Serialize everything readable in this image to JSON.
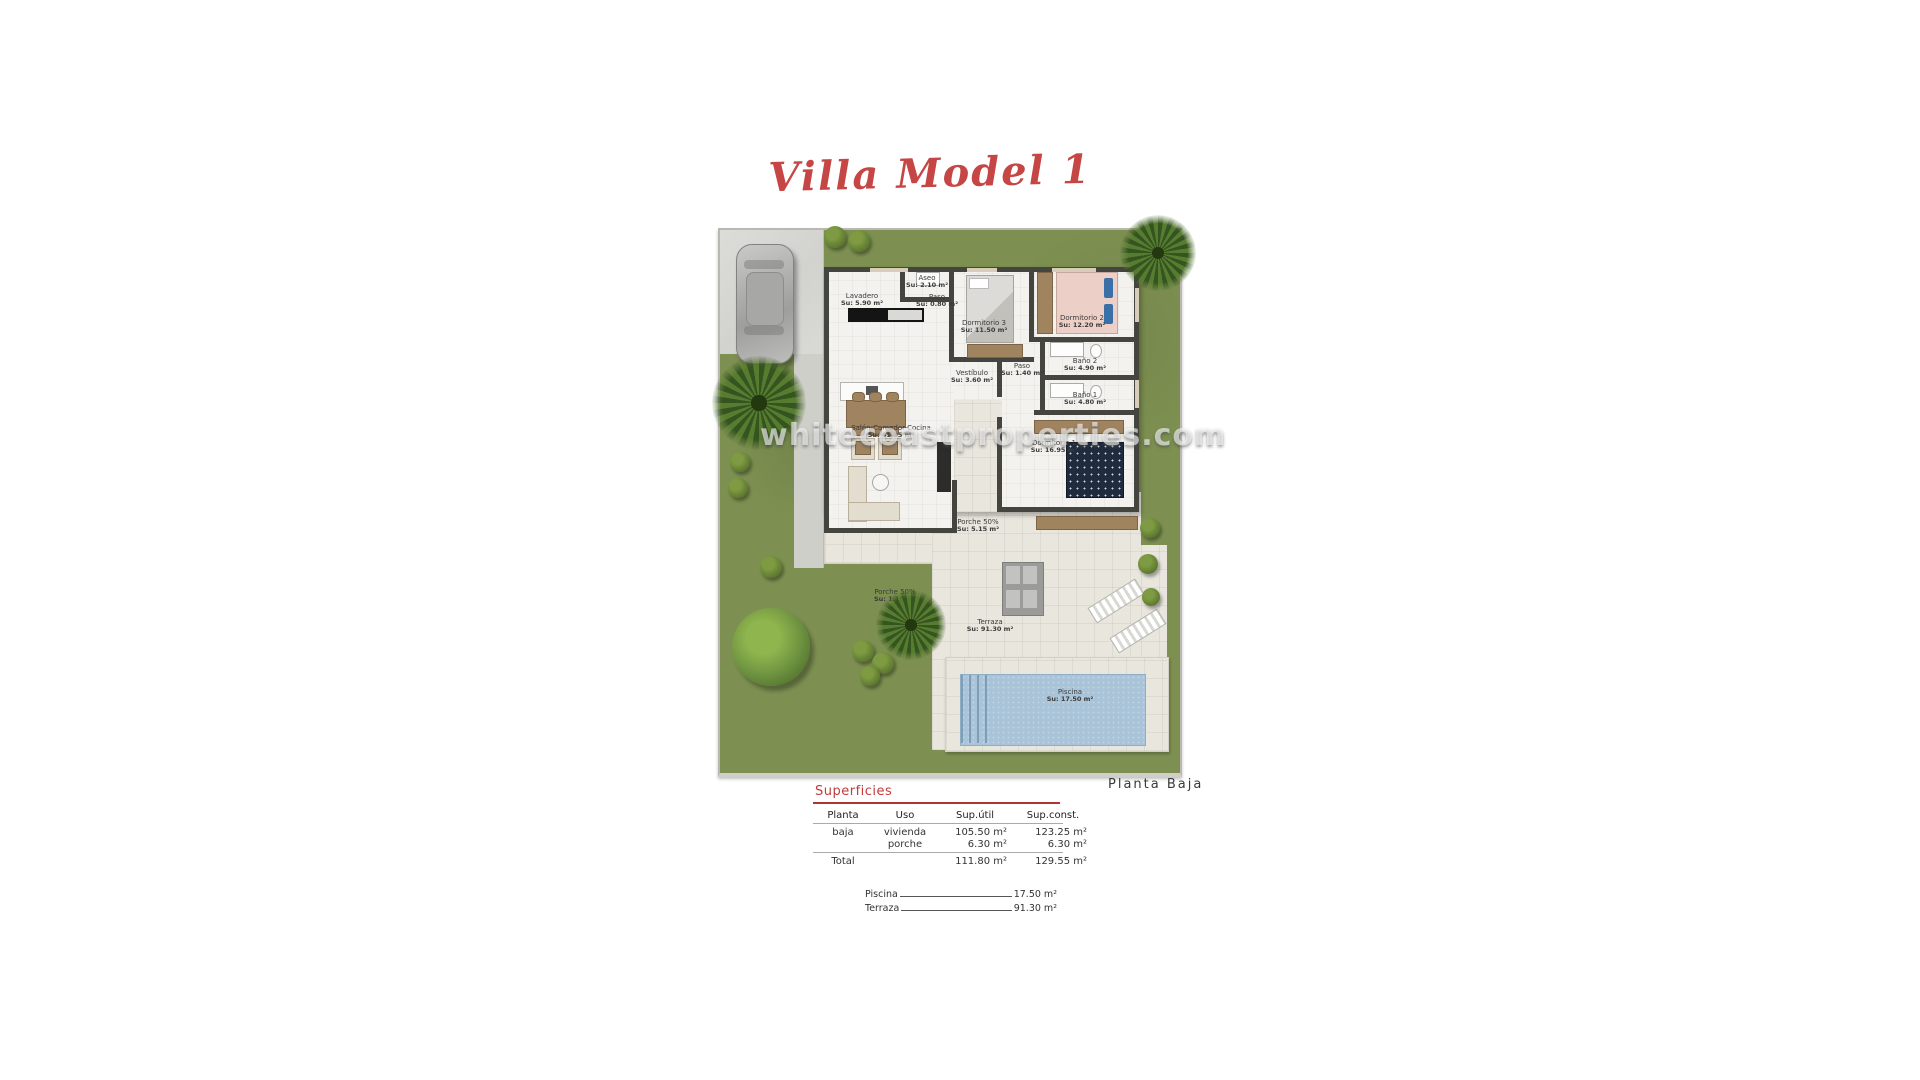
{
  "title": "Villa Model 1",
  "floor_label": "Planta Baja",
  "watermark": "whitecoastproperties.com",
  "colors": {
    "accent_red": "#c23b3b",
    "grass_green": "#7d9051",
    "pool_blue": "#a9c3d8"
  },
  "rooms": [
    {
      "name": "Lavadero",
      "area": "Su: 5.90 m²"
    },
    {
      "name": "Aseo",
      "area": "Su: 2.10 m²"
    },
    {
      "name": "Paso",
      "area": "Su: 0.80 m²"
    },
    {
      "name": "Dormitorio 3",
      "area": "Su: 11.50 m²"
    },
    {
      "name": "Dormitorio 2",
      "area": "Su: 12.20 m²"
    },
    {
      "name": "Baño 2",
      "area": "Su: 4.90 m²"
    },
    {
      "name": "Paso",
      "area": "Su: 1.40 m²"
    },
    {
      "name": "Vestíbulo",
      "area": "Su: 3.60 m²"
    },
    {
      "name": "Baño 1",
      "area": "Su: 4.80 m²"
    },
    {
      "name": "Salón-Comedor-Cocina",
      "area": "Su: 41.35 m²"
    },
    {
      "name": "Dormitorio 1",
      "area": "Su: 16.95 m²"
    },
    {
      "name": "Porche 50%",
      "area": "Su: 5.15 m²"
    },
    {
      "name": "Porche 50%",
      "area": "Su: 1.15 m²"
    },
    {
      "name": "Terraza",
      "area": "Su: 91.30 m²"
    },
    {
      "name": "Piscina",
      "area": "Su: 17.50 m²"
    }
  ],
  "superficies": {
    "heading": "Superficies",
    "columns": [
      "Planta",
      "Uso",
      "Sup.útil",
      "Sup.const."
    ],
    "rows": [
      {
        "planta": "baja",
        "uso": "vivienda",
        "sup_util": "105.50 m²",
        "sup_const": "123.25 m²"
      },
      {
        "planta": "",
        "uso": "porche",
        "sup_util": "6.30 m²",
        "sup_const": "6.30 m²"
      }
    ],
    "total": {
      "label": "Total",
      "sup_util": "111.80 m²",
      "sup_const": "129.55 m²"
    },
    "notes": [
      {
        "label": "Piscina",
        "value": "17.50 m²"
      },
      {
        "label": "Terraza",
        "value": "91.30 m²"
      }
    ]
  }
}
